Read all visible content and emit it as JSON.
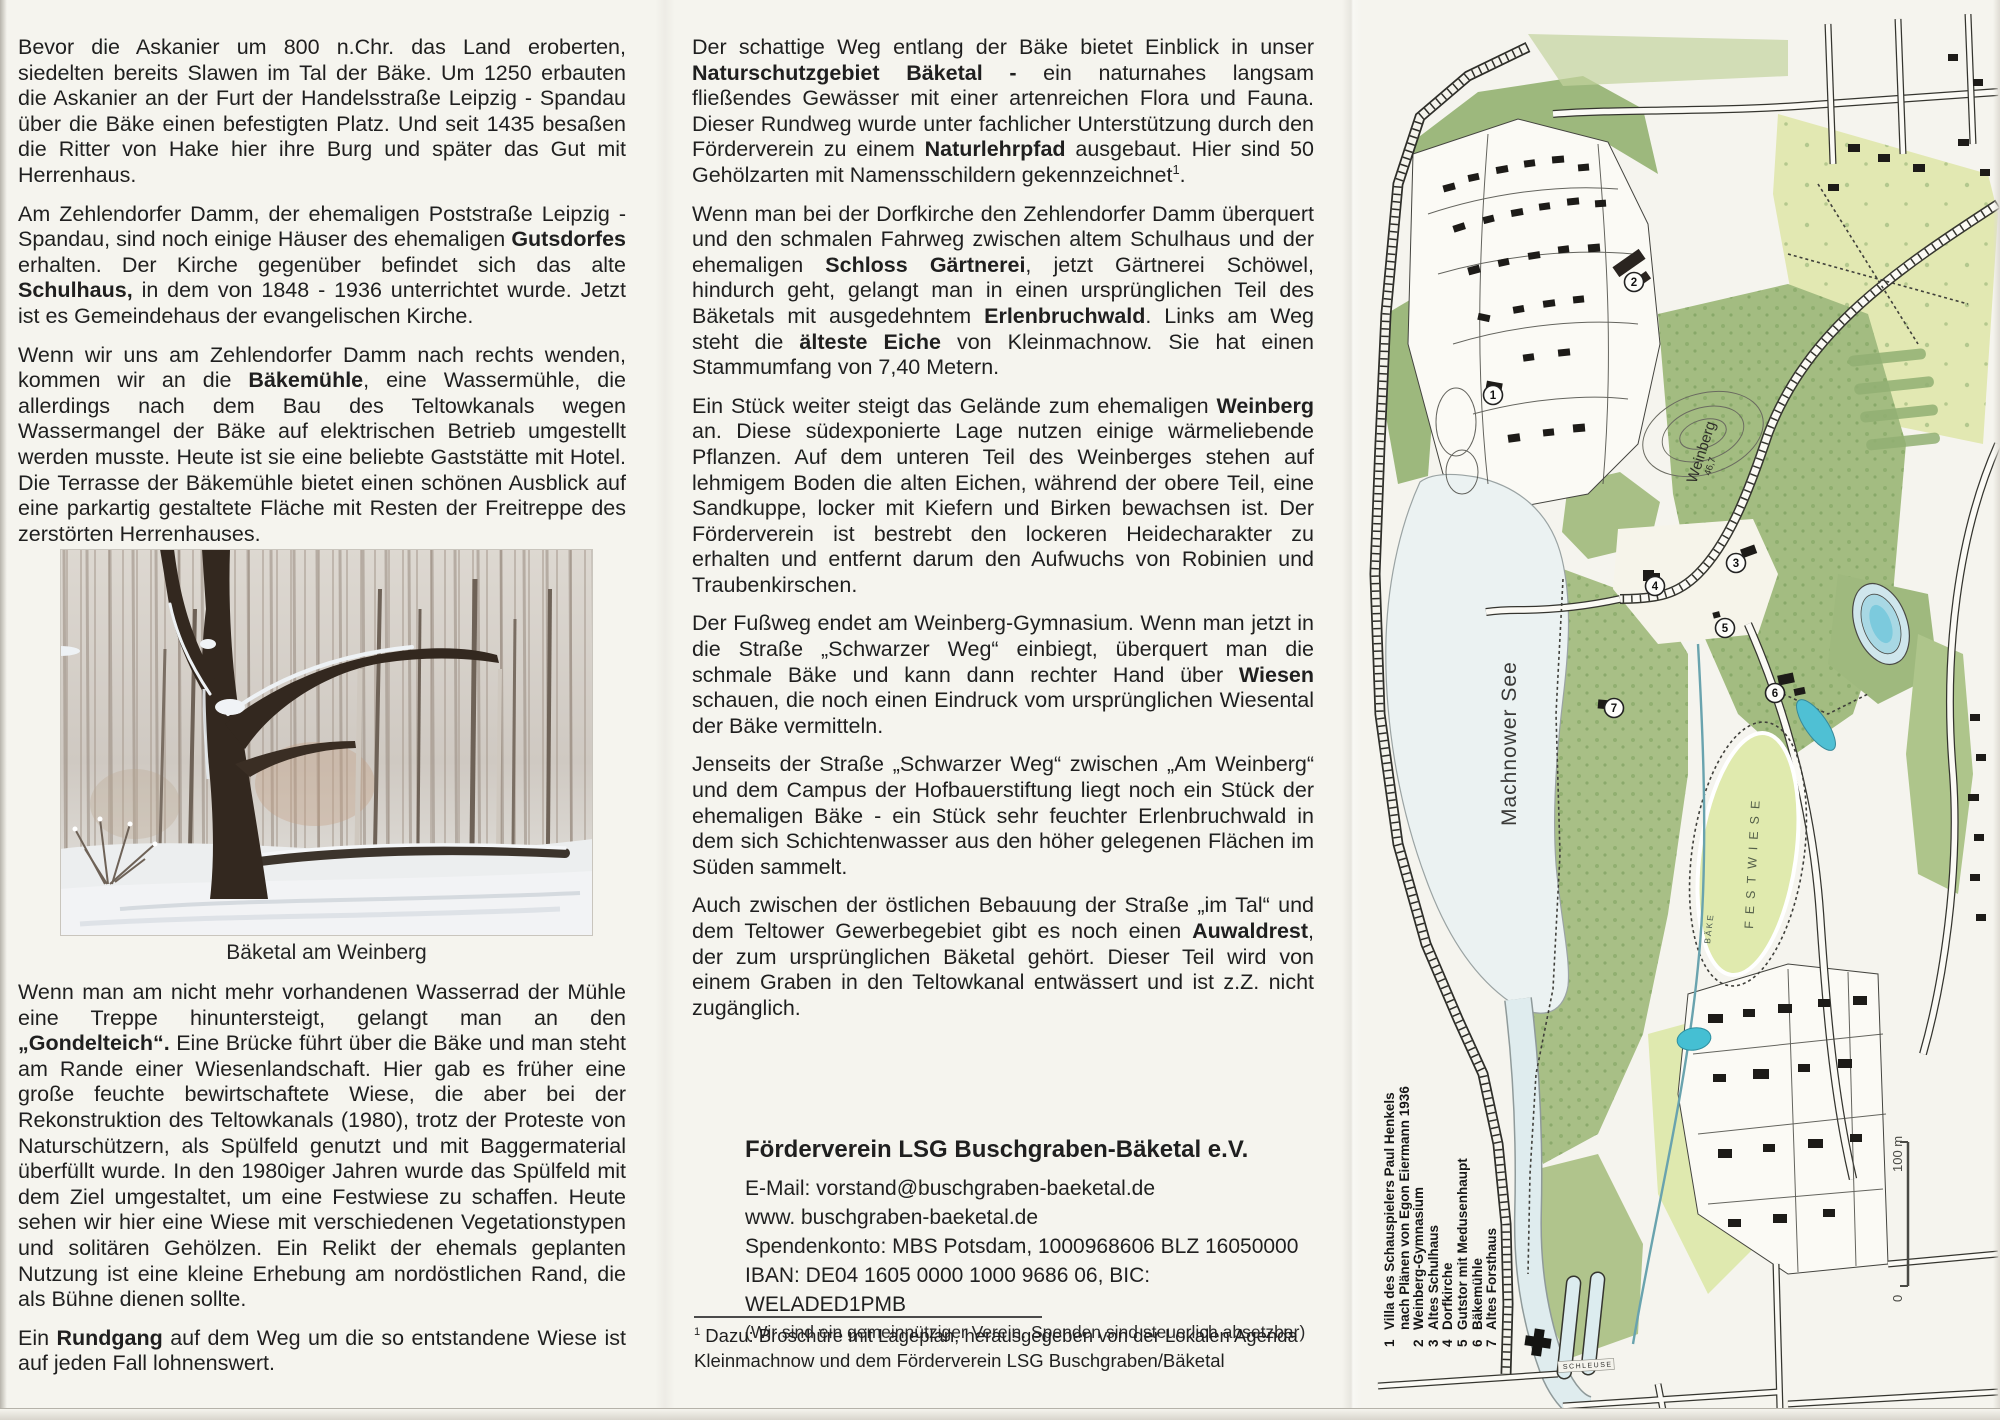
{
  "left_column": {
    "photo_caption": "Bäketal am Weinberg",
    "paragraphs_top": [
      {
        "runs": [
          {
            "t": "Bevor die Askanier um 800 n.Chr. das Land eroberten, siedelten bereits Slawen im Tal der Bäke. Um 1250 erbauten die Askanier an der Furt der Handelsstraße Leipzig - Spandau über die Bäke einen befestigten Platz. Und seit 1435 besaßen die Ritter von Hake hier ihre Burg und später das Gut mit Herrenhaus."
          }
        ]
      },
      {
        "runs": [
          {
            "t": "Am Zehlendorfer Damm, der ehemaligen Poststraße Leipzig - Spandau, sind noch einige Häuser des ehemaligen "
          },
          {
            "t": "Gutsdorfes",
            "b": true
          },
          {
            "t": " erhalten. Der Kirche gegenüber befindet sich das alte "
          },
          {
            "t": "Schulhaus,",
            "b": true
          },
          {
            "t": " in dem von 1848 - 1936 unterrichtet wurde. Jetzt ist es Gemeindehaus der evangelischen Kirche."
          }
        ]
      },
      {
        "runs": [
          {
            "t": "Wenn wir uns am Zehlendorfer Damm nach rechts wenden, kommen wir an die "
          },
          {
            "t": "Bäkemühle",
            "b": true
          },
          {
            "t": ", eine Wassermühle, die allerdings nach dem Bau des Teltowkanals wegen Wassermangel der Bäke auf elektrischen Betrieb umgestellt werden musste. Heute ist sie eine beliebte Gaststätte mit Hotel. Die Terrasse der Bäkemühle bietet einen schönen Ausblick auf eine parkartig gestaltete Fläche mit Resten der Freitreppe des zerstörten Herrenhauses."
          }
        ]
      }
    ],
    "paragraphs_bottom": [
      {
        "runs": [
          {
            "t": "Wenn man am nicht mehr vorhandenen Wasserrad der Mühle eine Treppe hinuntersteigt, gelangt man an den "
          },
          {
            "t": "„Gondelteich“.",
            "b": true
          },
          {
            "t": " Eine Brücke führt über die Bäke und man steht am Rande einer Wiesenlandschaft. Hier gab es früher eine große feuchte bewirtschaftete Wiese, die aber bei der Rekonstruktion des Teltowkanals (1980), trotz der Proteste von Naturschützern, als Spülfeld genutzt und mit Baggermaterial überfüllt wurde. In den 1980iger Jahren wurde das Spülfeld mit dem Ziel umgestaltet, um eine Festwiese zu schaffen. Heute sehen wir hier eine Wiese mit verschiedenen Vegetationstypen und solitären Gehölzen. Ein Relikt der ehemals geplanten Nutzung ist eine kleine Erhebung am nordöstlichen Rand, die als Bühne dienen sollte."
          }
        ]
      },
      {
        "runs": [
          {
            "t": "Ein "
          },
          {
            "t": "Rundgang",
            "b": true
          },
          {
            "t": " auf dem Weg um die so entstandene Wiese ist auf jeden Fall lohnenswert."
          }
        ]
      }
    ]
  },
  "middle_column": {
    "paragraphs": [
      {
        "runs": [
          {
            "t": "Der schattige Weg entlang der Bäke bietet Einblick in unser "
          },
          {
            "t": "Naturschutzgebiet Bäketal -",
            "b": true
          },
          {
            "t": " ein naturnahes langsam fließendes Gewässer mit einer artenreichen Flora und Fauna. Dieser Rundweg wurde unter fachlicher Unterstützung durch den Förderverein zu einem "
          },
          {
            "t": "Naturlehrpfad",
            "b": true
          },
          {
            "t": " ausgebaut. Hier sind 50 Gehölzarten mit Namensschildern gekennzeichnet"
          },
          {
            "t": "1",
            "sup": true
          },
          {
            "t": "."
          }
        ]
      },
      {
        "runs": [
          {
            "t": "Wenn man bei der Dorfkirche den Zehlendorfer Damm überquert und den schmalen Fahrweg zwischen altem Schulhaus und der ehemaligen "
          },
          {
            "t": "Schloss Gärtnerei",
            "b": true
          },
          {
            "t": ", jetzt Gärtnerei Schöwel, hindurch geht, gelangt man in einen ursprünglichen Teil des Bäketals mit ausgedehntem "
          },
          {
            "t": "Erlenbruchwald",
            "b": true
          },
          {
            "t": ". Links am Weg steht die "
          },
          {
            "t": "älteste Eiche",
            "b": true
          },
          {
            "t": " von Kleinmachnow. Sie hat einen Stammumfang von 7,40 Metern."
          }
        ]
      },
      {
        "runs": [
          {
            "t": "Ein Stück weiter steigt das Gelände zum ehemaligen "
          },
          {
            "t": "Weinberg",
            "b": true
          },
          {
            "t": " an. Diese südexponierte Lage nutzen einige wärmeliebende Pflanzen. Auf dem unteren Teil des Weinberges stehen auf lehmigem Boden die alten Eichen, während der obere Teil, eine Sandkuppe, locker mit Kiefern und Birken bewachsen ist. Der Förderverein ist bestrebt den lockeren Heidecharakter zu erhalten und entfernt darum den Aufwuchs von Robinien und Traubenkirschen."
          }
        ]
      },
      {
        "runs": [
          {
            "t": "Der Fußweg endet am Weinberg-Gymnasium. Wenn man jetzt in die Straße „Schwarzer Weg“ einbiegt, überquert man die schmale Bäke und kann dann rechter Hand über "
          },
          {
            "t": "Wiesen",
            "b": true
          },
          {
            "t": " schauen, die noch einen Eindruck vom ursprünglichen Wiesental der Bäke vermitteln."
          }
        ]
      },
      {
        "runs": [
          {
            "t": "Jenseits der Straße „Schwarzer Weg“ zwischen „Am Weinberg“ und dem Campus der Hofbauerstiftung liegt noch ein Stück der ehemaligen Bäke - ein Stück sehr feuchter Erlenbruchwald in dem sich Schichtenwasser aus den höher gelegenen Flächen im Süden sammelt."
          }
        ]
      },
      {
        "runs": [
          {
            "t": "Auch zwischen der östlichen Bebauung der Straße „im Tal“ und dem Teltower Gewerbegebiet gibt es noch einen "
          },
          {
            "t": "Auwaldrest",
            "b": true
          },
          {
            "t": ", der zum ursprünglichen Bäketal gehört. Dieser Teil wird von einem Graben in den Teltowkanal entwässert und ist z.Z. nicht zugänglich."
          }
        ]
      }
    ]
  },
  "contact": {
    "title": "Förderverein LSG Buschgraben-Bäketal e.V.",
    "lines": [
      "E-Mail: vorstand@buschgraben-baeketal.de",
      "www. buschgraben-baeketal.de",
      "Spendenkonto: MBS Potsdam, 1000968606 BLZ 16050000",
      "IBAN: DE04 1605 0000 1000 9686 06, BIC: WELADED1PMB"
    ],
    "note": "(Wir sind ein gemeinnütziger Verein. Spenden sind steuerlich absetzbar)"
  },
  "footnote": {
    "marker": "1",
    "text": " Dazu: Broschüre mit Lageplan, herausgegeben von der Lokalen Agenda Kleinmachnow und dem Förderverein LSG Buschgraben/Bäketal"
  },
  "map": {
    "legend": [
      {
        "num": "1",
        "text": "Villa des Schauspielers Paul Henkels"
      },
      {
        "num": "",
        "text": "nach Plänen von Egon Eiermann 1936"
      },
      {
        "num": "2",
        "text": "Weinberg-Gymnasium"
      },
      {
        "num": "3",
        "text": "Altes Schulhaus"
      },
      {
        "num": "4",
        "text": "Dorfkirche"
      },
      {
        "num": "5",
        "text": "Gutstor mit Medusenhaupt"
      },
      {
        "num": "6",
        "text": "Bäkemühle"
      },
      {
        "num": "7",
        "text": "Altes Forsthaus"
      }
    ],
    "markers": [
      "1",
      "2",
      "3",
      "4",
      "5",
      "6",
      "7"
    ],
    "labels": {
      "lake": "Machnower See",
      "hill": "Weinberg",
      "hill_elevation": "46,7",
      "meadow": "FESTWIESE",
      "stream": "BÄKE",
      "lock": "SCHLEUSE",
      "scale_zero": "0",
      "scale_label": "100 m"
    },
    "colors": {
      "forest_green": "#a3bc81",
      "field_yellow_green": "#e2e8b2",
      "lake_blue": "#ebf2f2",
      "pond_teal": "#4fc0d4",
      "building_black": "#1d1b18",
      "paper": "#f5f4ee"
    }
  }
}
